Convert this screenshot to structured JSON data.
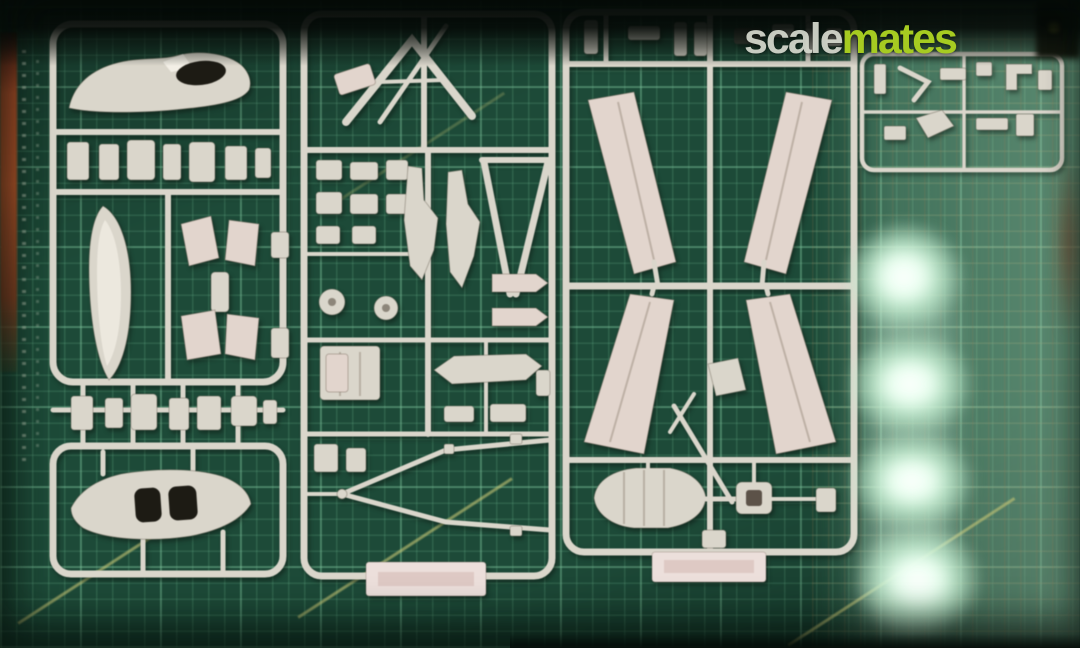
{
  "watermark": {
    "prefix": "scale",
    "suffix": "mates"
  },
  "palette": {
    "mat_dark": "#1d4a38",
    "mat_fine_line": "#4f8a6c",
    "mat_bold_line": "#5d9c7c",
    "mat_light": "#9cc8ab",
    "plastic": "#dad6cb",
    "plastic_pink": "#e2d5cd",
    "plastic_shadow": "#a79f92",
    "label_tab": "#ecdfdb",
    "shadow": "#070c09",
    "wood": "#b5532c",
    "glare": "#f4fff6",
    "watermark_scale": "#d7dacf",
    "watermark_mates": "#a6cb21"
  }
}
